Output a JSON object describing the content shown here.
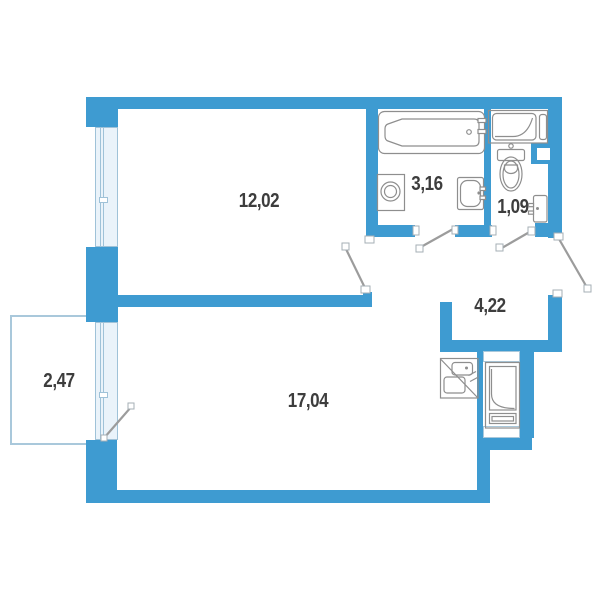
{
  "plan_title": "apartment-floor-plan",
  "rooms": [
    {
      "id": "bedroom",
      "area": "12,02"
    },
    {
      "id": "bathroom",
      "area": "3,16"
    },
    {
      "id": "wc",
      "area": "1,09"
    },
    {
      "id": "hallway",
      "area": "4,22"
    },
    {
      "id": "living-room",
      "area": "17,04"
    },
    {
      "id": "balcony",
      "area": "2,47"
    }
  ],
  "colors": {
    "wall": "#3E9BD1",
    "window_fill": "#EAF3FA",
    "window_border": "#9FC2D8",
    "light_border": "#A9C8DB",
    "fixture_line": "#8E8E8E",
    "door_line": "#9C9C9C",
    "label": "#3D3D3D",
    "jamb_border": "#A6AFB6"
  }
}
